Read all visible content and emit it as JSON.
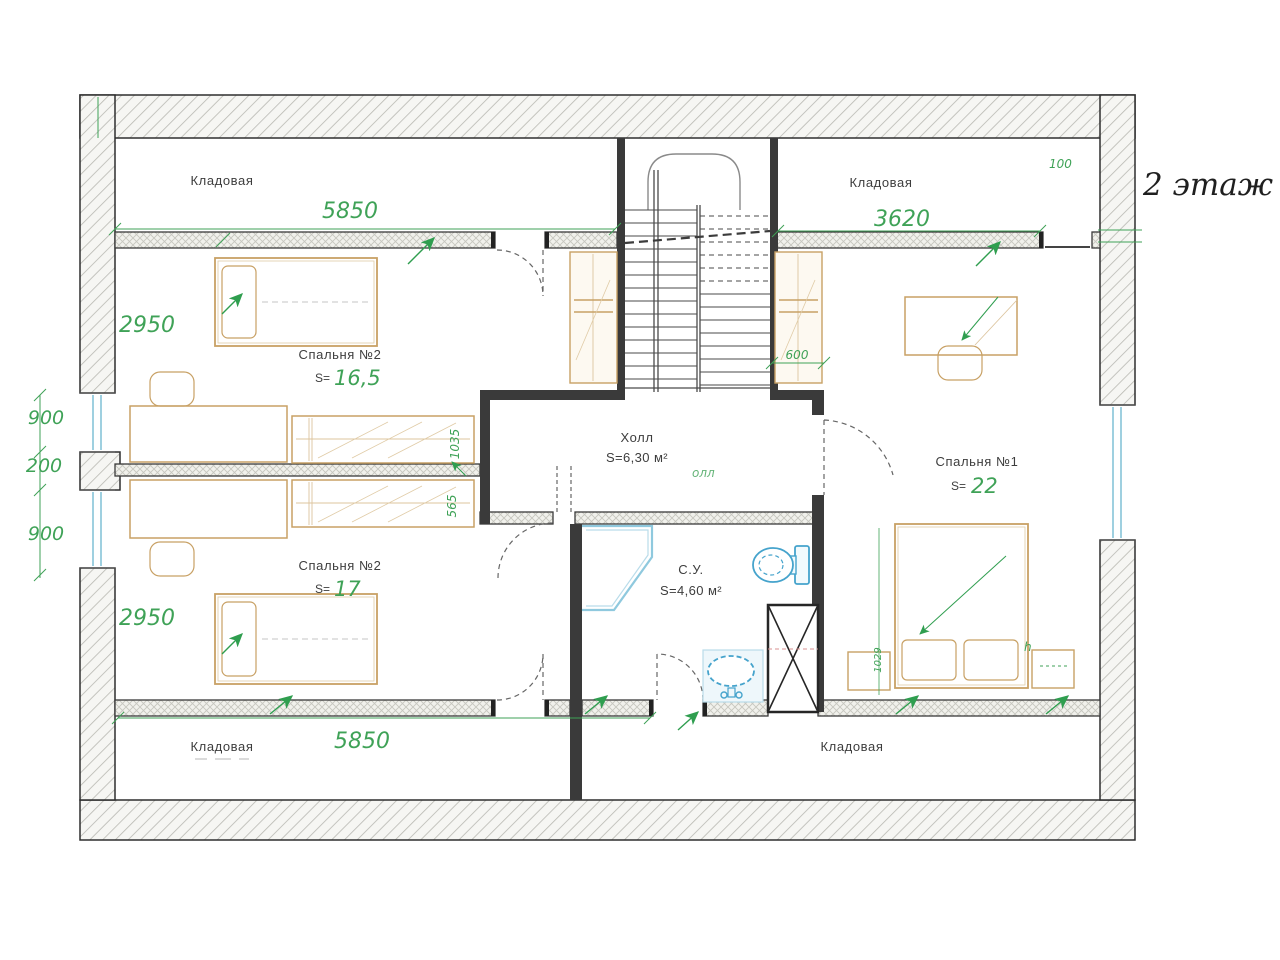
{
  "title": "2 этаж",
  "rooms": {
    "storage_top_left": {
      "label": "Кладовая"
    },
    "storage_top_right": {
      "label": "Кладовая"
    },
    "bedroom2_top": {
      "label": "Спальня №2",
      "s_prefix": "S=",
      "area": "16,5"
    },
    "bedroom2_bottom": {
      "label": "Спальня №2",
      "s_prefix": "S=",
      "area": "17"
    },
    "hall": {
      "label": "Холл",
      "area": "S=6,30 м²"
    },
    "bathroom": {
      "label": "С.У.",
      "area": "S=4,60 м²"
    },
    "bedroom1": {
      "label": "Спальня №1",
      "s_prefix": "S=",
      "area": "22"
    },
    "storage_bottom_left": {
      "label": "Кладовая"
    },
    "storage_bottom_right": {
      "label": "Кладовая"
    }
  },
  "dimensions": {
    "top_left_width": "5850",
    "top_right_width": "3620",
    "left_upper_height": "2950",
    "left_window_upper": "900",
    "left_pier": "200",
    "left_window_lower": "900",
    "left_lower_height": "2950",
    "bottom_width": "5850",
    "stair_closet_depth": "600",
    "wardrobe_upper": "1035",
    "wardrobe_lower": "565",
    "wall_offset": "100",
    "bed_offset": "1029",
    "note_hall": "олл",
    "note_h": "h"
  },
  "colors": {
    "dimension_green": "#3fa257",
    "wall_dark": "#2e2e2e",
    "furniture_tan": "#c8a165",
    "fixture_blue": "#45a3cc"
  }
}
